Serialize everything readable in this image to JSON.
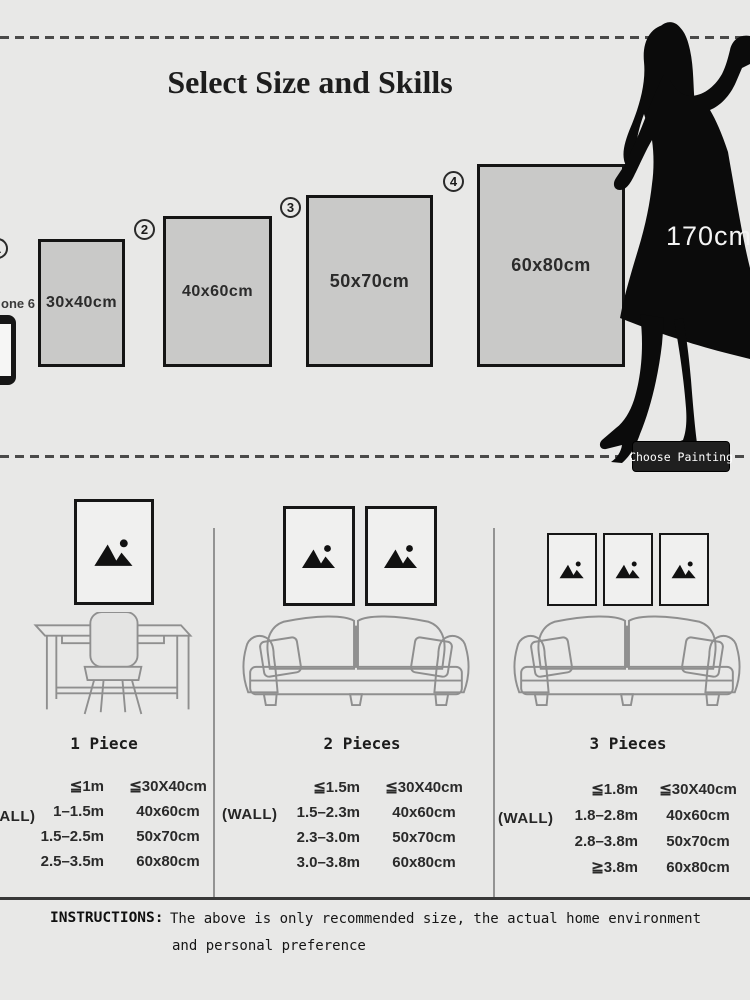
{
  "header": {
    "title": "Select Size and Skills"
  },
  "model": {
    "height_label": "170cm",
    "phone_label": "one 6"
  },
  "choose_button": {
    "label": "Choose Painting"
  },
  "size_options": [
    {
      "number": "1",
      "size": "30x40cm"
    },
    {
      "number": "2",
      "size": "40x60cm"
    },
    {
      "number": "3",
      "size": "50x70cm"
    },
    {
      "number": "4",
      "size": "60x80cm"
    }
  ],
  "scenes": [
    {
      "label": "1 Piece",
      "frame_count": 1
    },
    {
      "label": "2 Pieces",
      "frame_count": 2
    },
    {
      "label": "3 Pieces",
      "frame_count": 3
    }
  ],
  "size_tables": [
    {
      "wall_label": "(WALL)",
      "rows": [
        [
          "≦1m",
          "≦30X40cm"
        ],
        [
          "1–1.5m",
          "40x60cm"
        ],
        [
          "1.5–2.5m",
          "50x70cm"
        ],
        [
          "2.5–3.5m",
          "60x80cm"
        ]
      ]
    },
    {
      "wall_label": "(WALL)",
      "rows": [
        [
          "≦1.5m",
          "≦30X40cm"
        ],
        [
          "1.5–2.3m",
          "40x60cm"
        ],
        [
          "2.3–3.0m",
          "50x70cm"
        ],
        [
          "3.0–3.8m",
          "60x80cm"
        ]
      ]
    },
    {
      "wall_label": "(WALL)",
      "rows": [
        [
          "≦1.8m",
          "≦30X40cm"
        ],
        [
          "1.8–2.8m",
          "40x60cm"
        ],
        [
          "2.8–3.8m",
          "50x70cm"
        ],
        [
          "≧3.8m",
          "60x80cm"
        ]
      ]
    }
  ],
  "instructions": {
    "label": "INSTRUCTIONS:",
    "text_line1": "The above is only recommended size, the actual home environment",
    "text_line2": "and personal preference"
  },
  "colors": {
    "background": "#e8e8e7",
    "frame_fill": "#c9c9c8",
    "frame_border": "#141414",
    "silhouette": "#0b0b0b",
    "button_bg": "#1f1f1f",
    "button_text": "#ffffff",
    "dash_line": "#4a4a4a"
  }
}
